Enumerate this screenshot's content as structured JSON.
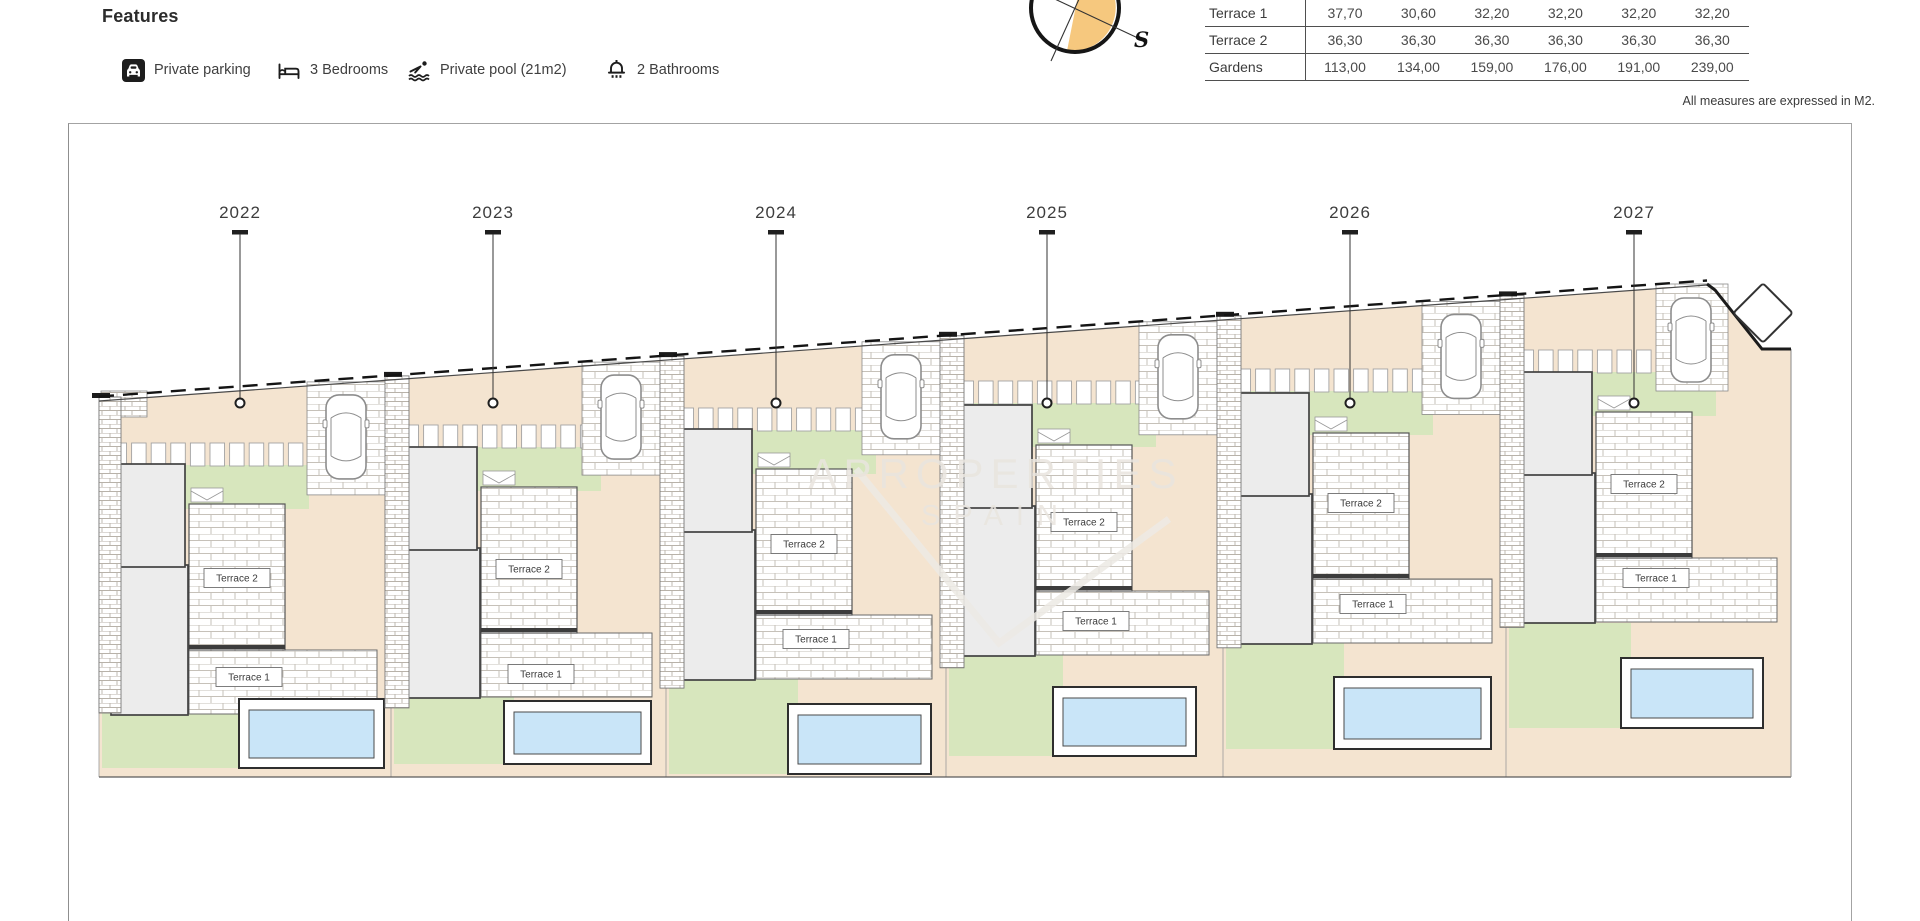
{
  "features": {
    "title": "Features",
    "items": [
      {
        "icon": "parking-icon",
        "label": "Private parking"
      },
      {
        "icon": "bed-icon",
        "label": "3 Bedrooms"
      },
      {
        "icon": "pool-icon",
        "label": "Private pool (21m2)"
      },
      {
        "icon": "bathroom-icon",
        "label": "2 Bathrooms"
      }
    ]
  },
  "compass": {
    "south_label": "S",
    "accent_color": "#f6c87e"
  },
  "spec_table": {
    "rows": [
      {
        "label": "Terrace 1",
        "values": [
          "37,70",
          "30,60",
          "32,20",
          "32,20",
          "32,20",
          "32,20"
        ]
      },
      {
        "label": "Terrace 2",
        "values": [
          "36,30",
          "36,30",
          "36,30",
          "36,30",
          "36,30",
          "36,30"
        ]
      },
      {
        "label": "Gardens",
        "values": [
          "113,00",
          "134,00",
          "159,00",
          "176,00",
          "191,00",
          "239,00"
        ]
      }
    ],
    "note": "All measures are expressed in M2."
  },
  "plan": {
    "plots": [
      {
        "id": "2022"
      },
      {
        "id": "2023"
      },
      {
        "id": "2024"
      },
      {
        "id": "2025"
      },
      {
        "id": "2026"
      },
      {
        "id": "2027"
      }
    ],
    "terrace1_label": "Terrace 1",
    "terrace2_label": "Terrace 2",
    "watermark": {
      "line1": "APROPERTIES",
      "line2": "SPAIN"
    },
    "colors": {
      "ground": "#f4e4d0",
      "garden": "#d7e6bd",
      "pool_water": "#c9e5f8",
      "pool_deck": "#ffffff",
      "building": "#ececec"
    }
  }
}
